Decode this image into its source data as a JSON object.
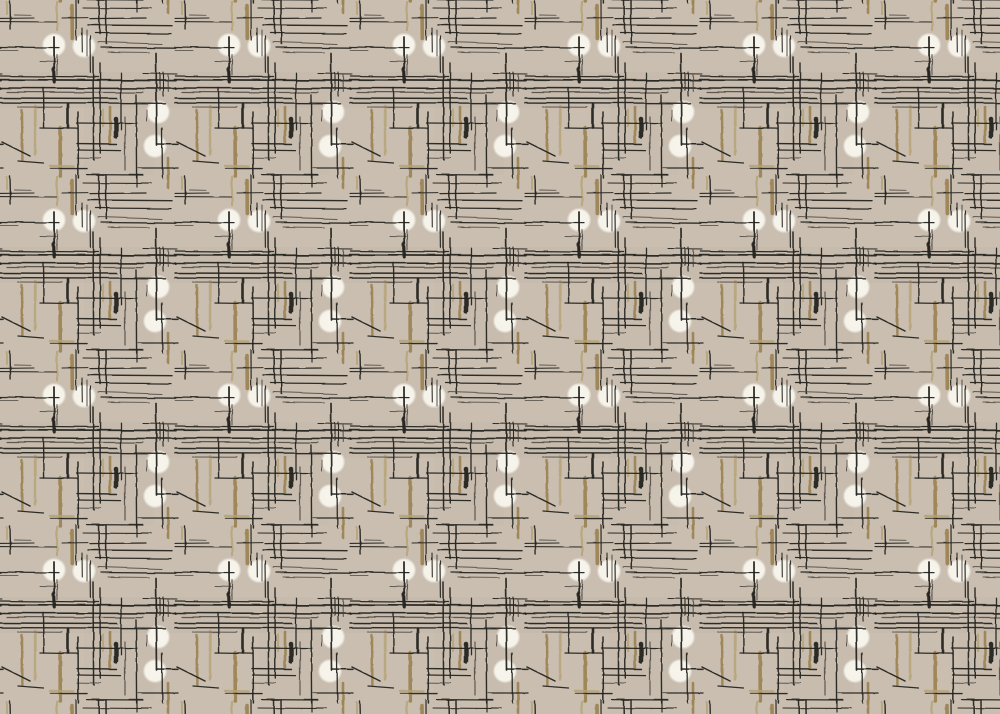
{
  "artwork": {
    "description": "Mid-century modern abstract textile/wallpaper pattern: sketchy charcoal crosshatch lines, olive-tan brush strokes and soft white dots on a warm greige ground",
    "canvas": {
      "width": 1000,
      "height": 714
    },
    "tile": {
      "width": 175,
      "height": 175
    },
    "colors": {
      "background": "#c9beb0",
      "background_shadow": "#bfb4a5",
      "line_dark": "#262420",
      "line_soft": "#46413a",
      "tan_dark": "#9d8454",
      "tan_light": "#b5a176",
      "dot_white": "#f7f4ec"
    },
    "dots": [
      [
        54,
        45,
        12.5
      ],
      [
        84,
        46,
        12.5
      ],
      [
        158,
        112,
        12.5
      ],
      [
        155,
        146,
        12.5
      ]
    ],
    "black_strokes": [
      [
        10,
        1,
        10.6,
        29,
        1.4,
        0
      ],
      [
        0,
        18.4,
        34,
        18,
        1.1,
        0
      ],
      [
        14,
        15,
        31,
        15.3,
        0.9,
        1
      ],
      [
        0,
        21.6,
        56,
        22,
        1.1,
        0
      ],
      [
        62,
        18,
        88,
        17.6,
        1.0,
        0
      ],
      [
        0,
        47,
        59,
        47.6,
        1.3,
        0
      ],
      [
        0,
        50.6,
        18,
        50.6,
        0.9,
        1
      ],
      [
        40,
        61,
        56,
        61.3,
        0.9,
        1
      ],
      [
        54,
        37,
        54.2,
        76,
        1.8,
        0
      ],
      [
        53.6,
        68,
        54.2,
        82,
        3.2,
        0
      ],
      [
        76,
        0,
        76.2,
        40,
        1.2,
        0
      ],
      [
        82,
        28,
        82.3,
        52,
        1.1,
        0
      ],
      [
        87,
        30,
        87,
        56,
        1.1,
        1
      ],
      [
        90,
        36,
        90.4,
        73,
        1.2,
        0
      ],
      [
        99,
        0,
        99.6,
        34,
        1.5,
        0
      ],
      [
        106,
        0,
        106.3,
        44,
        1.5,
        0
      ],
      [
        137,
        0,
        137,
        12,
        1.2,
        0
      ],
      [
        83,
        8,
        151,
        8.6,
        1.1,
        0
      ],
      [
        90,
        18.6,
        146,
        18,
        1.3,
        0
      ],
      [
        88,
        25,
        172,
        25.7,
        1.4,
        0
      ],
      [
        95,
        33,
        171,
        33.6,
        1.3,
        0
      ],
      [
        98,
        42,
        162,
        44,
        1.1,
        1
      ],
      [
        101,
        47.5,
        176,
        48.2,
        1.3,
        0
      ],
      [
        108,
        52,
        150,
        52.4,
        0.9,
        1
      ],
      [
        0,
        76,
        98,
        77,
        1.3,
        0
      ],
      [
        143,
        73.5,
        177,
        74,
        1.1,
        0
      ],
      [
        -1,
        79.6,
        176,
        80.6,
        1.8,
        0
      ],
      [
        0,
        88,
        176,
        88.6,
        1.6,
        0
      ],
      [
        7,
        92,
        143,
        92.6,
        1.2,
        1
      ],
      [
        0,
        98,
        117,
        98.5,
        1.4,
        0
      ],
      [
        0,
        102.6,
        166,
        103.3,
        1.4,
        0
      ],
      [
        18,
        107,
        62,
        107.2,
        1.0,
        1
      ],
      [
        57,
        55,
        57,
        75,
        1.1,
        1
      ],
      [
        93,
        57,
        93.6,
        160,
        1.5,
        0
      ],
      [
        100,
        63,
        100.3,
        153,
        1.4,
        0
      ],
      [
        121,
        73,
        121,
        130,
        1.3,
        0
      ],
      [
        156,
        53,
        157,
        145,
        1.7,
        0
      ],
      [
        157,
        144,
        178,
        144.4,
        1.5,
        0
      ],
      [
        160,
        73,
        160,
        91,
        1.1,
        0
      ],
      [
        163.5,
        72,
        163.5,
        96,
        1.1,
        0
      ],
      [
        168,
        74,
        168.3,
        92,
        1.1,
        1
      ],
      [
        162,
        128,
        162.4,
        178,
        1.3,
        0
      ],
      [
        147,
        110,
        147,
        121,
        1.0,
        1
      ],
      [
        136,
        95,
        136.6,
        178,
        1.4,
        0
      ],
      [
        125,
        117,
        125,
        170,
        1.2,
        1
      ],
      [
        43,
        88,
        43.6,
        128,
        1.4,
        0
      ],
      [
        68,
        104,
        68,
        128,
        2.6,
        0
      ],
      [
        2,
        142,
        30,
        156,
        1.5,
        0
      ],
      [
        18,
        161,
        44,
        163,
        1.2,
        0
      ],
      [
        77,
        123,
        137,
        123.6,
        1.3,
        0
      ],
      [
        40,
        128,
        77,
        128.6,
        1.2,
        0
      ],
      [
        77,
        143.6,
        117,
        144,
        1.4,
        0
      ],
      [
        77,
        150,
        121,
        150.6,
        1.3,
        0
      ],
      [
        77,
        157.6,
        100,
        158,
        1.0,
        1
      ],
      [
        50,
        168.6,
        87,
        168.6,
        1.4,
        0
      ],
      [
        87,
        174.6,
        143,
        175,
        1.2,
        0
      ],
      [
        138,
        168,
        178,
        168,
        1.3,
        0
      ],
      [
        78,
        112,
        78.4,
        178,
        1.5,
        0
      ],
      [
        116,
        119,
        116,
        136,
        4.5,
        0
      ]
    ],
    "tan_strokes": [
      [
        57,
        2,
        57,
        30,
        2.2,
        1
      ],
      [
        72,
        6,
        72.3,
        38,
        3.6,
        0
      ],
      [
        7,
        2,
        7,
        14,
        2.0,
        1
      ],
      [
        168,
        0,
        168,
        13,
        2.6,
        0
      ],
      [
        22,
        110,
        22.4,
        160,
        2.4,
        0
      ],
      [
        35,
        106,
        35,
        155,
        2.4,
        1
      ],
      [
        60,
        128,
        60.3,
        176,
        3.6,
        0
      ],
      [
        103,
        110,
        103,
        126,
        2.2,
        1
      ],
      [
        110,
        107,
        110,
        142,
        2.6,
        0
      ],
      [
        50,
        166,
        74,
        166.5,
        2.4,
        1
      ],
      [
        168,
        158,
        168,
        178,
        2.6,
        0
      ]
    ]
  }
}
